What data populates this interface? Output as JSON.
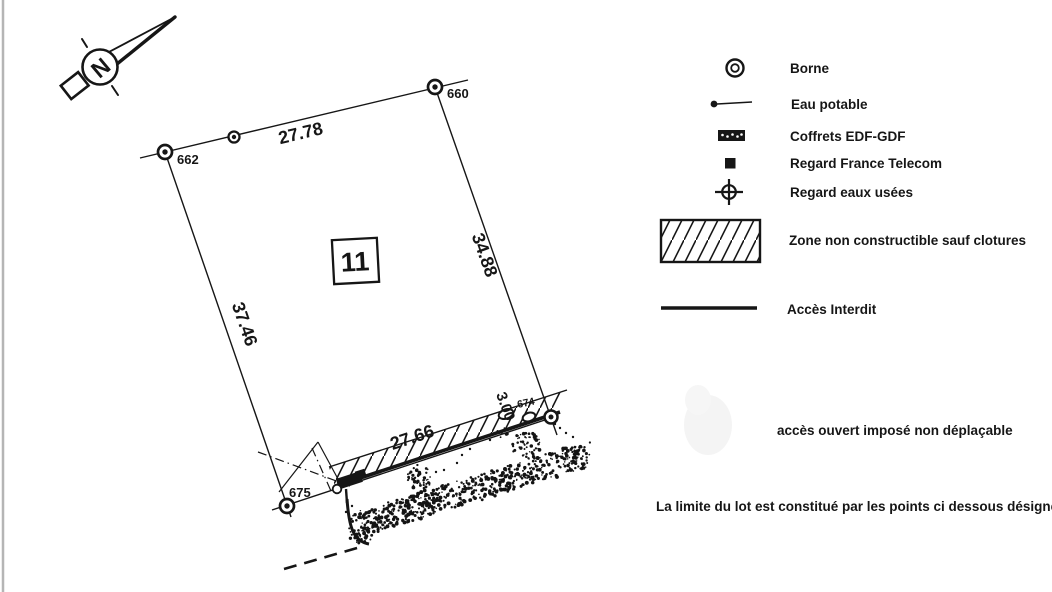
{
  "north": {
    "label": "N"
  },
  "parcel": {
    "number": "11"
  },
  "dimensions": {
    "top": "27.78",
    "right": "34.88",
    "left": "37.46",
    "bottom": "27.66",
    "strip_width": "3.00"
  },
  "points": {
    "topleft": "662",
    "topright": "660",
    "bottomleft": "675",
    "bottomright": "674"
  },
  "legend": {
    "items": [
      {
        "icon": "borne-icon",
        "label": "Borne"
      },
      {
        "icon": "eau-potable-icon",
        "label": "Eau potable"
      },
      {
        "icon": "coffret-edf-gdf-icon",
        "label": "Coffrets EDF-GDF"
      },
      {
        "icon": "regard-telecom-icon",
        "label": "Regard France Telecom"
      },
      {
        "icon": "regard-eaux-usees-icon",
        "label": "Regard eaux usées"
      },
      {
        "icon": "zone-hatch-swatch-icon",
        "label": "Zone non constructible sauf clotures"
      },
      {
        "icon": "acces-interdit-line-icon",
        "label": "Accès Interdit"
      }
    ]
  },
  "notes": {
    "acces": "accès ouvert imposé non déplaçable",
    "limite": "La limite du lot est constitué par les points ci dessous désignés"
  },
  "colors": {
    "ink": "#161616",
    "paper": "#ffffff",
    "scan_border": "#b5b5b5"
  }
}
